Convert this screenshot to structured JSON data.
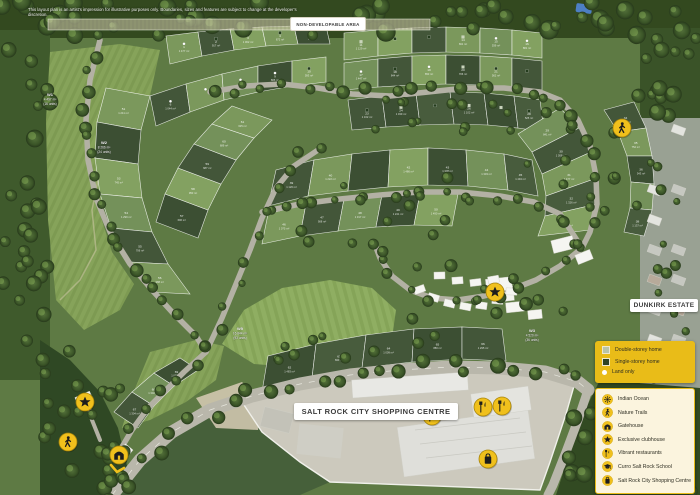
{
  "disclaimer": "This layout plan is an artist's impression for illustrative purposes only. Boundaries, sizes and features are subject to change at the developer's discretion.",
  "labels": {
    "non_developable": "NON-DEVELOPABLE AREA",
    "dunkirk": "DUNKIRK ESTATE",
    "shopping_centre": "SALT ROCK CITY SHOPPING CENTRE"
  },
  "legend": {
    "home_types": [
      {
        "icon": "double-storey-square",
        "label": "Double-storey home"
      },
      {
        "icon": "single-storey-square",
        "label": "Single-storey home"
      },
      {
        "icon": "land-only-dot",
        "label": "Land only"
      }
    ],
    "amenities": [
      {
        "icon": "sun",
        "label": "Indian Ocean"
      },
      {
        "icon": "walker",
        "label": "Nature Trails"
      },
      {
        "icon": "gatehouse",
        "label": "Gatehouse"
      },
      {
        "icon": "star",
        "label": "Exclusive clubhouse"
      },
      {
        "icon": "restaurant",
        "label": "Vibrant restaurants"
      },
      {
        "icon": "graduation-cap",
        "label": "Curro Salt Rock School"
      },
      {
        "icon": "shopping-bag",
        "label": "Salt Rock City Shopping Centre"
      }
    ]
  },
  "map": {
    "markers": [
      {
        "icon": "walker",
        "x": 622,
        "y": 128
      },
      {
        "icon": "star",
        "x": 495,
        "y": 292
      },
      {
        "icon": "star",
        "x": 85,
        "y": 402
      },
      {
        "icon": "walker",
        "x": 68,
        "y": 442
      },
      {
        "icon": "gatehouse",
        "x": 119,
        "y": 455,
        "chevron": true
      },
      {
        "icon": "restaurant",
        "x": 432,
        "y": 416
      },
      {
        "icon": "restaurant",
        "x": 483,
        "y": 407
      },
      {
        "icon": "restaurant",
        "x": 502,
        "y": 406
      },
      {
        "icon": "shopping-bag",
        "x": 488,
        "y": 459
      }
    ],
    "area_labels": [
      {
        "x": 50,
        "y": 96,
        "lines": [
          "W1",
          "4 497 m²",
          "(16 units)"
        ]
      },
      {
        "x": 104,
        "y": 144,
        "lines": [
          "W2",
          "8 266 m²",
          "(24 units)"
        ]
      },
      {
        "x": 240,
        "y": 330,
        "lines": [
          "W5",
          "16 844 m²",
          "(93 units)"
        ]
      },
      {
        "x": 532,
        "y": 332,
        "lines": [
          "W3",
          "4 520 m²",
          "(36 units)"
        ]
      }
    ]
  },
  "colors": {
    "accent_yellow": "#F0C01C",
    "legend_gold": "#E9BC18",
    "legend_cream": "#FBF4DE",
    "estate_green": "#5e7a44",
    "ink": "#1d1d1d"
  }
}
